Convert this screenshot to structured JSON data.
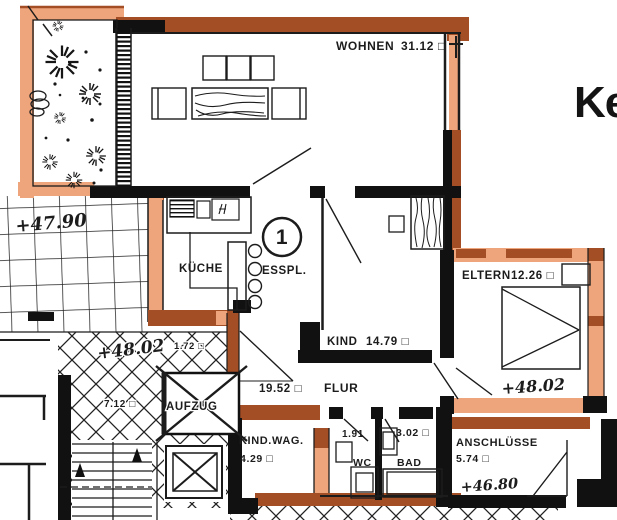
{
  "title": "apartment-floor-plan",
  "colors": {
    "wall_dark": "#a44e26",
    "wall_light": "#efa57b",
    "ink": "#1c1c1c",
    "paper": "#ffffff"
  },
  "unit_label": "1",
  "edge_text": "Ke",
  "rooms": {
    "wohnen": {
      "name": "WOHNEN",
      "area": "31.12 □"
    },
    "kueche": {
      "name": "KÜCHE"
    },
    "esspl": {
      "name": "ESSPL."
    },
    "kind": {
      "name": "KIND",
      "area": "14.79 □"
    },
    "eltern": {
      "name": "ELTERN",
      "area": "12.26 □"
    },
    "flur": {
      "name": "FLUR",
      "area": "19.52 □"
    },
    "aufzug": {
      "name": "AUFZUG"
    },
    "kind_wag": {
      "name": "KIND.WAG.",
      "area": "4.29 □"
    },
    "wc": {
      "name": "WC",
      "area": "1.91"
    },
    "bad": {
      "name": "BAD",
      "area": "3.02 □"
    },
    "anschluesse": {
      "name": "ANSCHLÜSSE",
      "area": "5.74 □"
    },
    "stair_landing": {
      "area": "7.12 □"
    },
    "niche": {
      "area": "1.72 □"
    }
  },
  "elevations": {
    "terrace": "+47.90",
    "stair_landing": "+48.02",
    "eltern": "+48.02",
    "anschluesse": "+46.80"
  }
}
